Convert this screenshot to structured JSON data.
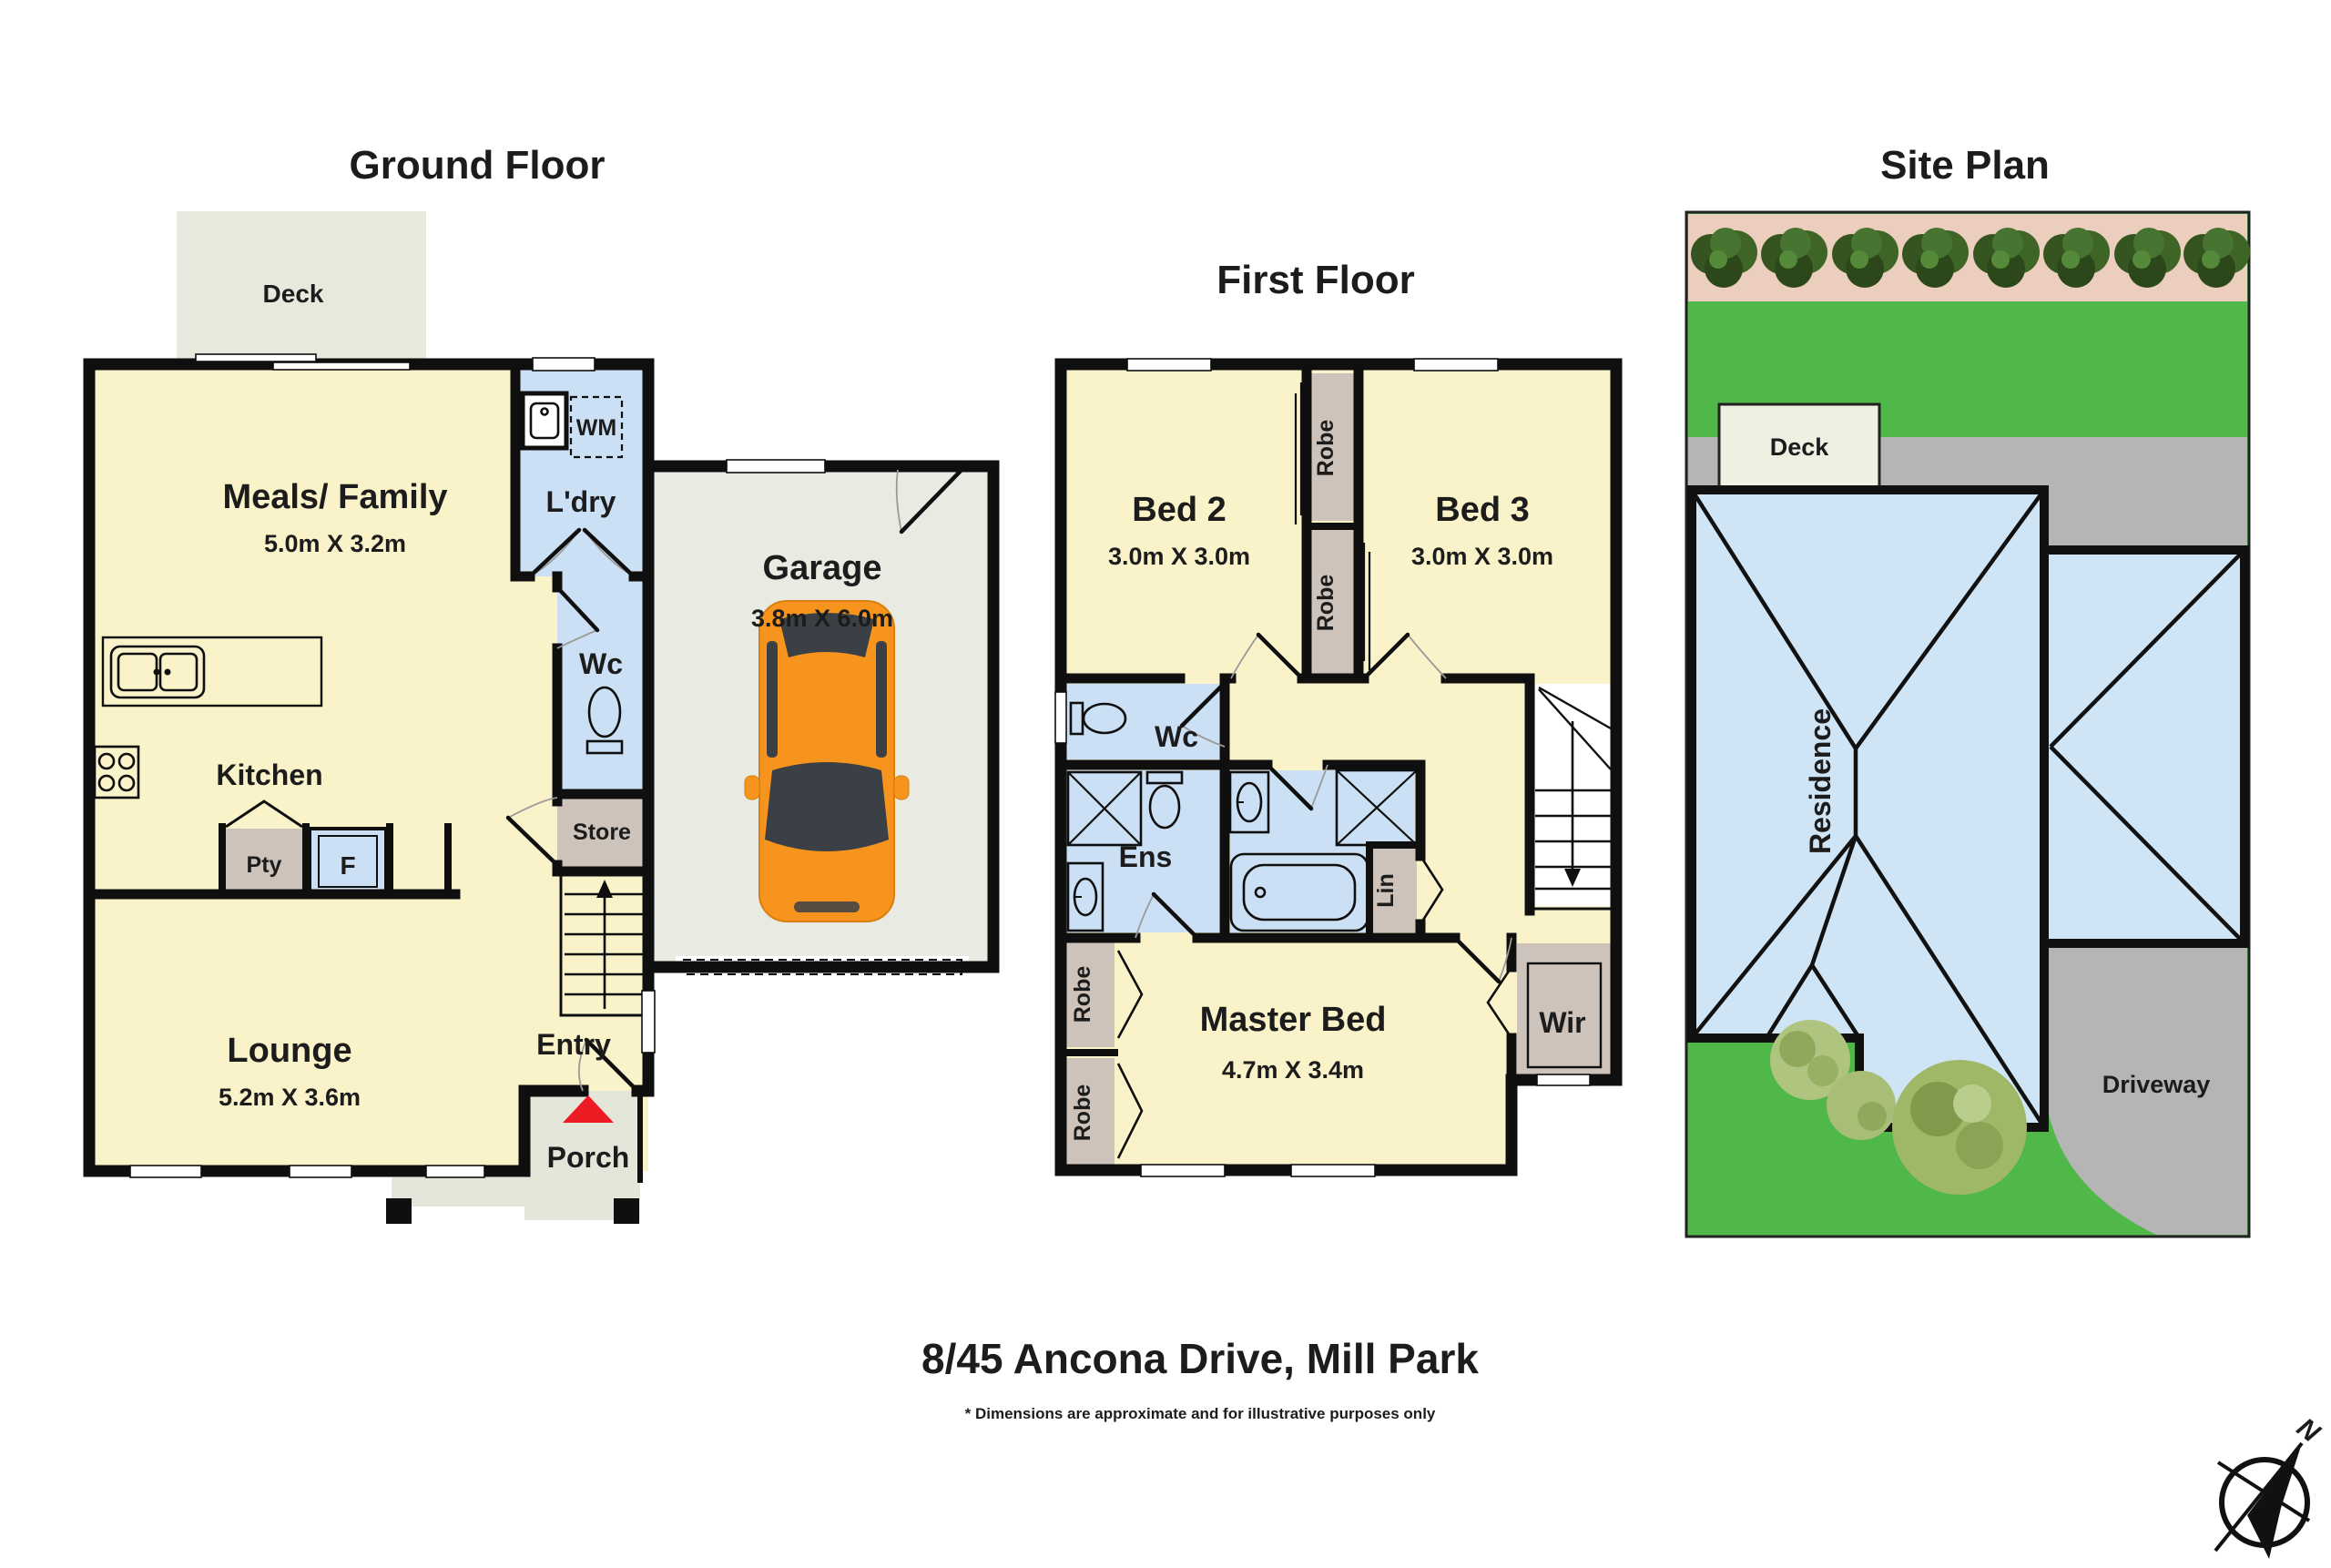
{
  "page": {
    "address": "8/45 Ancona Drive, Mill Park",
    "disclaimer": "* Dimensions are approximate and for illustrative purposes only",
    "compass": "N"
  },
  "ground_floor": {
    "title": "Ground Floor",
    "deck": "Deck",
    "meals_family": "Meals/ Family",
    "meals_family_dims": "5.0m X 3.2m",
    "ldry": "L'dry",
    "wm": "WM",
    "wc": "Wc",
    "store": "Store",
    "kitchen": "Kitchen",
    "pty": "Pty",
    "fridge": "F",
    "lounge": "Lounge",
    "lounge_dims": "5.2m X 3.6m",
    "entry": "Entry",
    "porch": "Porch",
    "garage": "Garage",
    "garage_dims": "3.8m X 6.0m"
  },
  "first_floor": {
    "title": "First Floor",
    "bed2": "Bed 2",
    "bed2_dims": "3.0m X 3.0m",
    "bed3": "Bed 3",
    "bed3_dims": "3.0m X 3.0m",
    "robe": "Robe",
    "wc": "Wc",
    "ens": "Ens",
    "lin": "Lin",
    "master": "Master Bed",
    "master_dims": "4.7m X 3.4m",
    "wir": "Wir"
  },
  "site_plan": {
    "title": "Site Plan",
    "deck": "Deck",
    "residence": "Residence",
    "driveway": "Driveway"
  },
  "colors": {
    "room_yellow": "#FAF3C9",
    "wet_blue": "#CBE0F4",
    "robe_tan": "#CDC3BA",
    "deck_grey": "#E7E9DC",
    "garage_grey": "#E9EAE1",
    "porch_grey": "#E3E6D9",
    "wall_black": "#0F0F0F",
    "grass_green": "#4FB848",
    "road_grey": "#B5B5B5",
    "strip_tan": "#EBCEBD",
    "roof_blue": "#CFE5F6",
    "car_orange": "#F7941E",
    "marker_red": "#ED1C24"
  }
}
